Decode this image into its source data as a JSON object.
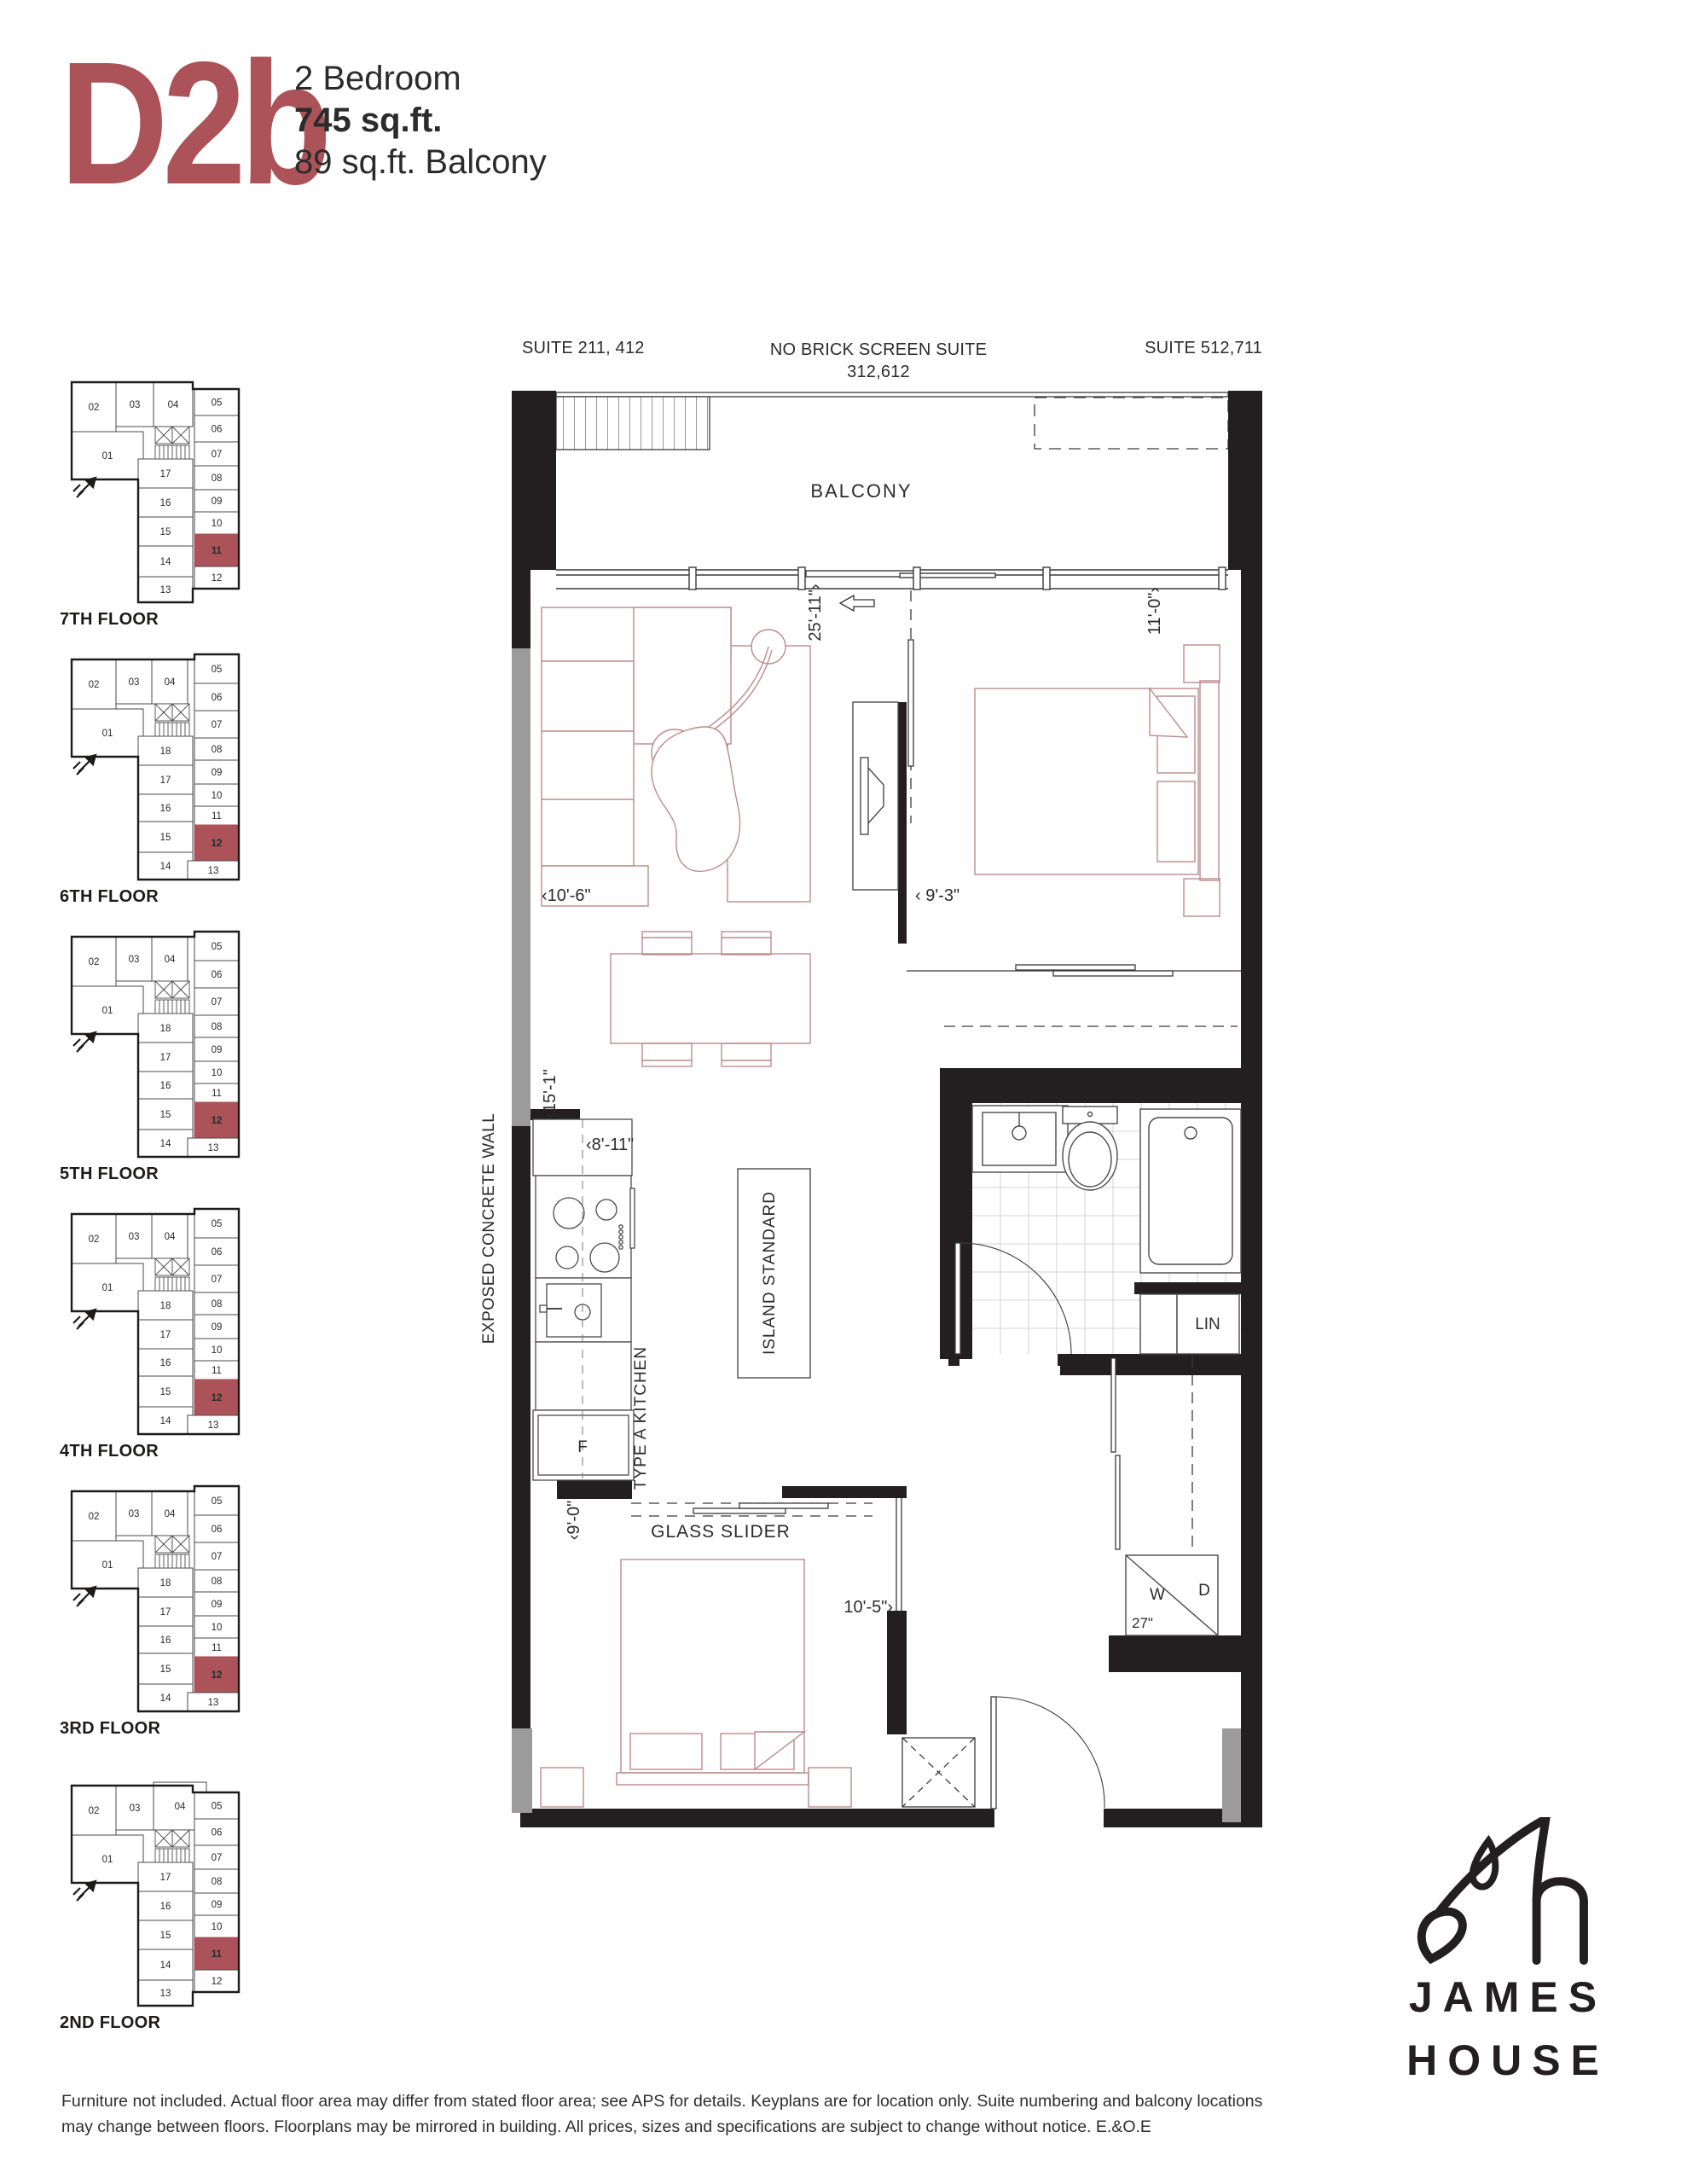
{
  "header": {
    "plan_code": "D2b",
    "line1": "2 Bedroom",
    "line2": "745 sq.ft.",
    "line3": "89 sq.ft. Balcony"
  },
  "colors": {
    "accent": "#ab5358",
    "wall": "#231f20",
    "concrete": "#9b9b9b",
    "furniture": "#bc8a8c"
  },
  "plan": {
    "suite_left": "SUITE 211, 412",
    "suite_center1": "NO BRICK SCREEN SUITE",
    "suite_center2": "312,612",
    "suite_right": "SUITE 512,711",
    "balcony": "BALCONY",
    "exposed_wall": "EXPOSED CONCRETE WALL",
    "glass_slider": "GLASS SLIDER",
    "island": "ISLAND STANDARD",
    "kitchen": "TYPE A KITCHEN",
    "linen": "LIN",
    "fridge": "F",
    "washer": "W",
    "dryer": "D",
    "dims": {
      "living_width": "25'-11\"›",
      "master_width": "11'-0\"›",
      "living_depth": "‹10'-6\"",
      "master_depth": "‹ 9'-3\"",
      "kitchen_run": "‹15'-1\"",
      "kitchen_width": "‹8'-11\"",
      "bedroom2_depth": "‹9'-0\"",
      "bedroom2_width": "10'-5\"›",
      "washer_dryer": "27\""
    }
  },
  "keyplans": [
    {
      "label": "7TH FLOOR",
      "variant": "A",
      "wide04": false,
      "highlight": "11",
      "top": [
        "02",
        "03",
        "04"
      ],
      "left": "01",
      "middle": [
        "17",
        "16",
        "15",
        "14",
        "13"
      ],
      "right": [
        "05",
        "06",
        "07",
        "08",
        "09",
        "10",
        "11",
        "12"
      ]
    },
    {
      "label": "6TH FLOOR",
      "variant": "B",
      "wide04": false,
      "highlight": "12",
      "top": [
        "02",
        "03",
        "04",
        "05"
      ],
      "left": "01",
      "middle": [
        "18",
        "17",
        "16",
        "15",
        "14"
      ],
      "right": [
        "06",
        "07",
        "08",
        "09",
        "10",
        "11",
        "12",
        "13"
      ]
    },
    {
      "label": "5TH FLOOR",
      "variant": "B",
      "wide04": false,
      "highlight": "12",
      "top": [
        "02",
        "03",
        "04",
        "05"
      ],
      "left": "01",
      "middle": [
        "18",
        "17",
        "16",
        "15",
        "14"
      ],
      "right": [
        "06",
        "07",
        "08",
        "09",
        "10",
        "11",
        "12",
        "13"
      ]
    },
    {
      "label": "4TH FLOOR",
      "variant": "B",
      "wide04": false,
      "highlight": "12",
      "top": [
        "02",
        "03",
        "04",
        "05"
      ],
      "left": "01",
      "middle": [
        "18",
        "17",
        "16",
        "15",
        "14"
      ],
      "right": [
        "06",
        "07",
        "08",
        "09",
        "10",
        "11",
        "12",
        "13"
      ]
    },
    {
      "label": "3RD FLOOR",
      "variant": "B",
      "wide04": false,
      "highlight": "12",
      "top": [
        "02",
        "03",
        "04",
        "05"
      ],
      "left": "01",
      "middle": [
        "18",
        "17",
        "16",
        "15",
        "14"
      ],
      "right": [
        "06",
        "07",
        "08",
        "09",
        "10",
        "11",
        "12",
        "13"
      ]
    },
    {
      "label": "2ND FLOOR",
      "variant": "A",
      "wide04": true,
      "highlight": "11",
      "top": [
        "02",
        "03",
        "04"
      ],
      "left": "01",
      "middle": [
        "17",
        "16",
        "15",
        "14",
        "13"
      ],
      "right": [
        "05",
        "06",
        "07",
        "08",
        "09",
        "10",
        "11",
        "12"
      ]
    }
  ],
  "footer": {
    "line1": "Furniture not included. Actual floor area may differ from stated floor area; see APS for details. Keyplans are for location only. Suite numbering and balcony locations",
    "line2": "may change between floors. Floorplans may be mirrored in building. All prices, sizes and specifications are subject to change without notice. E.&O.E"
  },
  "logo": {
    "line1": "JAMES",
    "line2": "HOUSE"
  }
}
